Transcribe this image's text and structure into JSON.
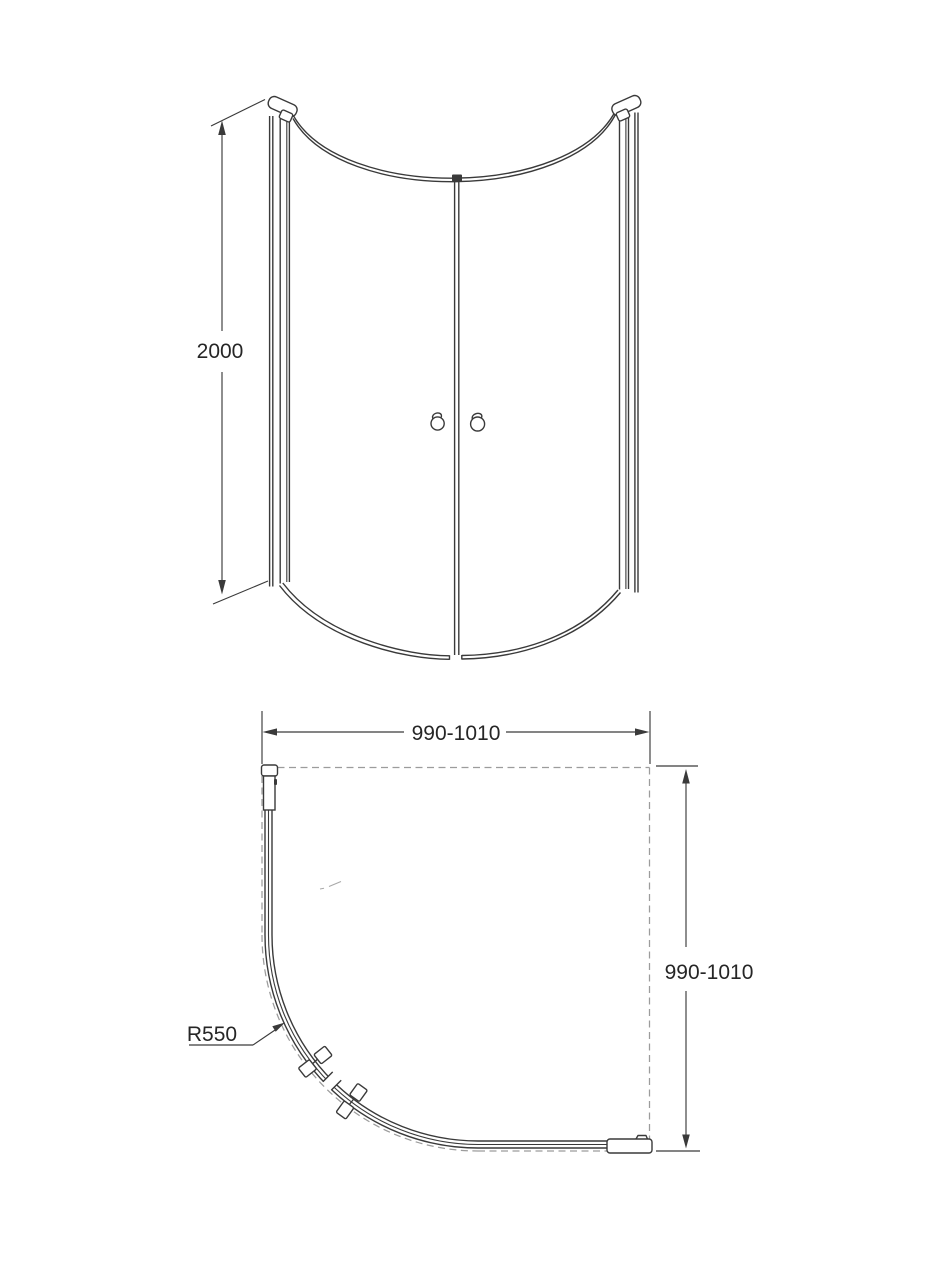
{
  "drawing": {
    "front_view": {
      "height_label": "2000"
    },
    "plan_view": {
      "width_label": "990-1010",
      "depth_label": "990-1010",
      "radius_label": "R550"
    },
    "colors": {
      "line": "#3a3a3a",
      "dash": "#9c9c9c",
      "text": "#262626",
      "background": "#ffffff"
    }
  }
}
